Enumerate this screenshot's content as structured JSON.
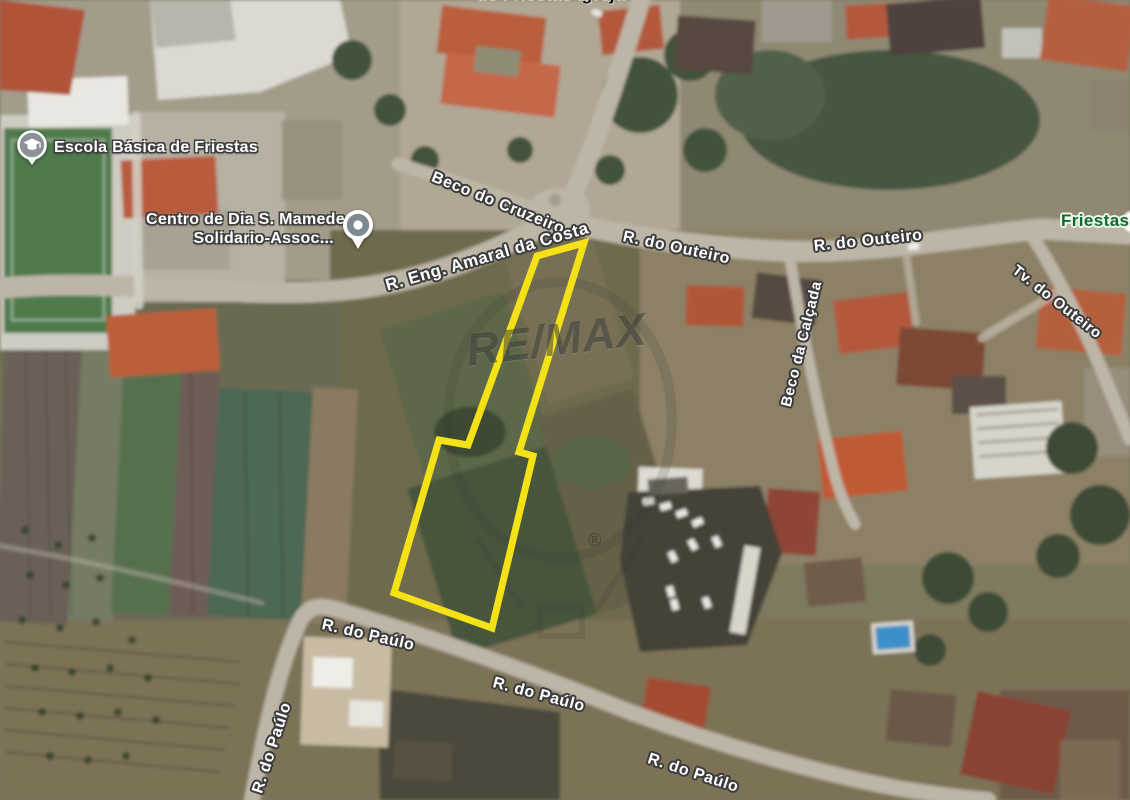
{
  "map": {
    "top_partial_label": "de Friestas Igreja",
    "locality": "Friestas",
    "pois": {
      "school": {
        "label": "Escola Básica de Friestas",
        "icon": "graduation-cap-pin"
      },
      "day_center": {
        "label_line1": "Centro de Dia S. Mamede",
        "label_line2": "Solidario-Assoc...",
        "icon": "map-pin"
      }
    },
    "streets": {
      "beco_do_cruzeiro": "Beco do Cruzeiro",
      "eng_amaral_da_costa": "R. Eng. Amaral da Costa",
      "r_do_outeiro_1": "R. do Outeiro",
      "r_do_outeiro_2": "R. do Outeiro",
      "tv_do_outeiro": "Tv. do Outeiro",
      "beco_da_calcada": "Beco da Calçada",
      "r_do_paulo_1": "R. do Paúlo",
      "r_do_paulo_2": "R. do Paúlo",
      "r_do_paulo_3": "R. do Paúlo",
      "r_do_paulo_4": "R. do Paúlo"
    },
    "watermark": {
      "brand": "RE/MAX",
      "registered": "®"
    },
    "parcel": {
      "points": "537,256 584,243 519,452 533,456 492,628 394,593 439,440 468,445",
      "outline_color": "#F5E216"
    },
    "colors": {
      "parcel_yellow": "#F5E216",
      "road": "#bdb6a7",
      "locality_green": "#0f6b2d",
      "poi_icon_gray": "#7d8a92"
    }
  }
}
